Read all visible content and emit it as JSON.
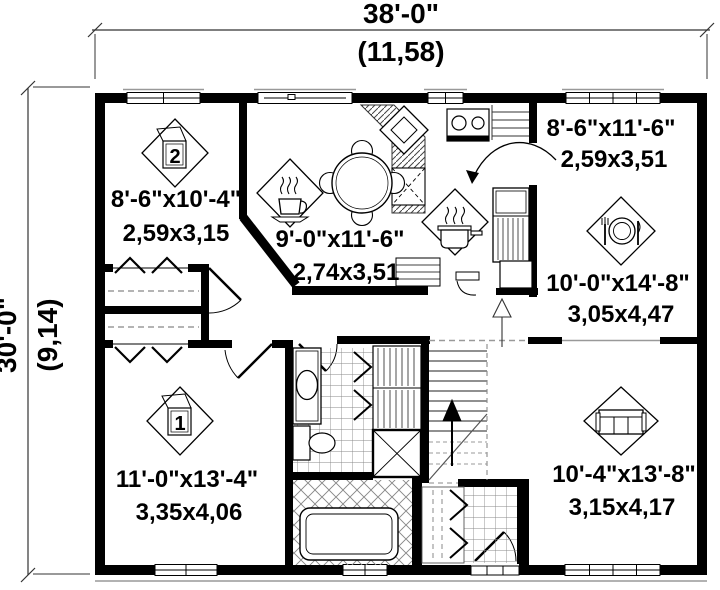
{
  "plan": {
    "title": "house-floor-plan",
    "dimensions": {
      "width_imperial": "38'-0\"",
      "width_metric": "(11,58)",
      "height_imperial": "30'-0\"",
      "height_metric": "(9,14)"
    },
    "rooms": [
      {
        "name": "bedroom-2",
        "number": "2",
        "size_imperial": "8'-6\"x10'-4\"",
        "size_metric": "2,59x3,15"
      },
      {
        "name": "dinette",
        "size_imperial": "9'-0\"x11'-6\"",
        "size_metric": "2,74x3,51"
      },
      {
        "name": "kitchen",
        "size_imperial": "8'-6\"x11'-6\"",
        "size_metric": "2,59x3,51"
      },
      {
        "name": "dining-room",
        "size_imperial": "10'-0\"x14'-8\"",
        "size_metric": "3,05x4,47"
      },
      {
        "name": "bedroom-1",
        "number": "1",
        "size_imperial": "11'-0\"x13'-4\"",
        "size_metric": "3,35x4,06"
      },
      {
        "name": "living-room",
        "size_imperial": "10'-4\"x13'-8\"",
        "size_metric": "3,15x4,17"
      }
    ],
    "colors": {
      "wall": "#000000",
      "line": "#333333",
      "tile": "#888888",
      "background": "#ffffff"
    }
  }
}
